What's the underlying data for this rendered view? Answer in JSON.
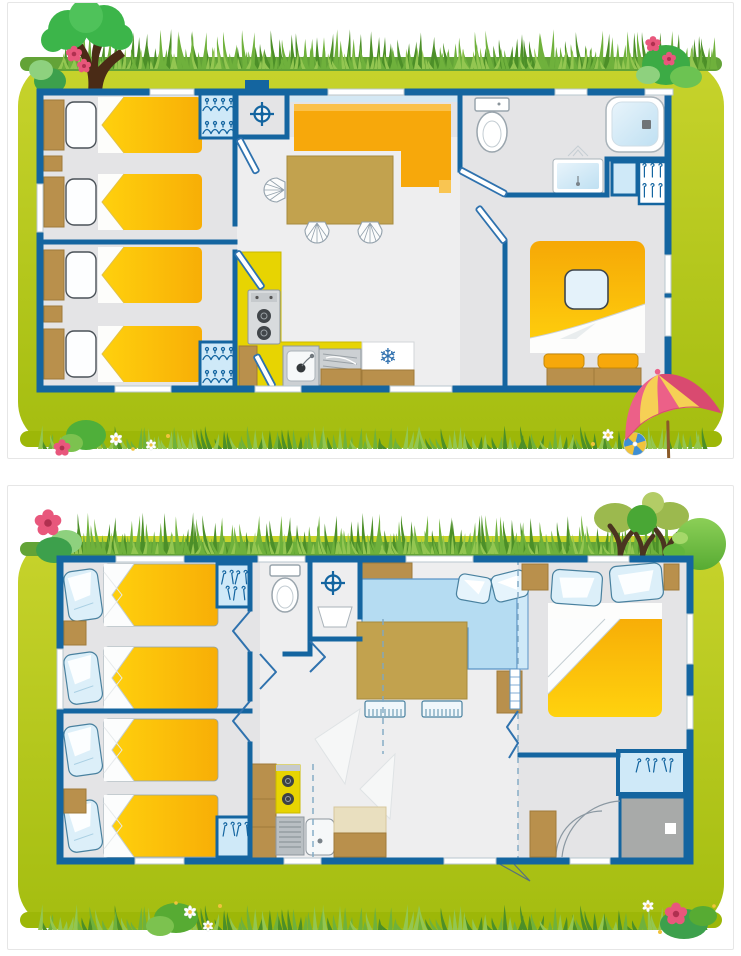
{
  "page": {
    "background": "#ffffff",
    "card_border": "#e6e6e6",
    "card_background": "#ffffff"
  },
  "icons": {
    "fridge_snowflake": "❄",
    "water_heater": "circle-cross-symbol",
    "hanger": "wardrobe-hanger-glyph"
  },
  "palette": {
    "wall": "#1465a0",
    "door_blue": "#2f72ae",
    "floor": "#e4e4e6",
    "floor_light": "#eeeeef",
    "bed_yellow": "#ffc90a",
    "bed_yellow_deep": "#f8ae06",
    "kitchen_yellow": "#e7d402",
    "sofa_orange": "#f7a80b",
    "sofa_orange_light": "#fbc14a",
    "sofa_blue": "#b5dcf2",
    "tan": "#c2a24e",
    "brown": "#b9904c",
    "brown_dk": "#a07a3a",
    "lt_blue": "#cfe9f8",
    "snow": "#2e6fae",
    "steel": "#ccd0d3",
    "steel_dk": "#8e979e",
    "shower_gray": "#a8aaa9",
    "lawn_hi": "#c7d32c",
    "lawn_lo": "#a4bd10",
    "lawn_band": "#9db708",
    "grass_base": "#63a337",
    "grass_dark": "#4c8f28",
    "grass_mid": "#6fb13c",
    "grass_light": "#93c651",
    "tree_green": "#3cb54a",
    "tree_olive": "#9cb94e",
    "tree_bright": "#49a735",
    "bush_light": "#8ed17e",
    "bush_dark": "#3da04c",
    "trunk": "#4a2b16",
    "trunk2": "#4a3420",
    "flower_pink": "#e8577c",
    "flower_dark": "#b03050",
    "daisy_yellow": "#f0c33c",
    "umb_pink": "#ec6088",
    "umb_pink_dk": "#d94a70",
    "umb_cream": "#f6d055",
    "pole": "#8a5a28",
    "ball_blue": "#3e8fd4"
  },
  "figures": [
    {
      "name": "floorplan-mobile-home-a",
      "decorations": [
        "tree",
        "flower-bush",
        "grass-border",
        "pink-flowers",
        "daisies",
        "parasol",
        "beach-ball"
      ],
      "rooms": [
        {
          "name": "bedroom-1",
          "furniture": [
            "single-bed",
            "single-bed",
            "nightstand",
            "hanger-wardrobe"
          ]
        },
        {
          "name": "bedroom-2",
          "furniture": [
            "single-bed",
            "single-bed",
            "nightstand",
            "hanger-wardrobe"
          ]
        },
        {
          "name": "technical-closet",
          "furniture": [
            "water-heater"
          ]
        },
        {
          "name": "living-room",
          "furniture": [
            "corner-sofa-orange",
            "dining-table",
            "wicker-chair",
            "wicker-chair",
            "wicker-chair"
          ]
        },
        {
          "name": "kitchen",
          "furniture": [
            "gas-hob",
            "sink",
            "drainer",
            "fridge",
            "cabinets"
          ]
        },
        {
          "name": "bathroom",
          "furniture": [
            "toilet",
            "shower",
            "washbasin",
            "hanger-closet"
          ]
        },
        {
          "name": "master-bedroom",
          "furniture": [
            "double-bed",
            "pillow",
            "bench-with-cushions"
          ]
        }
      ]
    },
    {
      "name": "floorplan-mobile-home-b",
      "decorations": [
        "pink-flower-bush",
        "grass-border",
        "three-trees",
        "round-bush",
        "daisies"
      ],
      "rooms": [
        {
          "name": "bedroom-1",
          "furniture": [
            "single-bed",
            "single-bed",
            "nightstand",
            "hanger-wardrobe"
          ]
        },
        {
          "name": "bedroom-2",
          "furniture": [
            "single-bed",
            "single-bed",
            "nightstand",
            "hanger-wardrobe"
          ]
        },
        {
          "name": "wc",
          "furniture": [
            "toilet"
          ]
        },
        {
          "name": "technical-closet",
          "furniture": [
            "water-heater",
            "washbasin"
          ]
        },
        {
          "name": "living-room",
          "furniture": [
            "corner-sofa-blue",
            "cushions",
            "dining-table",
            "bench",
            "bench",
            "shelf"
          ]
        },
        {
          "name": "kitchen",
          "furniture": [
            "gas-hob",
            "sink",
            "drainer",
            "cabinets"
          ]
        },
        {
          "name": "master-bedroom",
          "furniture": [
            "double-bed",
            "pillow",
            "pillow",
            "nightstand",
            "nightstand"
          ]
        },
        {
          "name": "bathroom",
          "furniture": [
            "hanger-wardrobe",
            "shower",
            "cabinet"
          ]
        }
      ]
    }
  ]
}
